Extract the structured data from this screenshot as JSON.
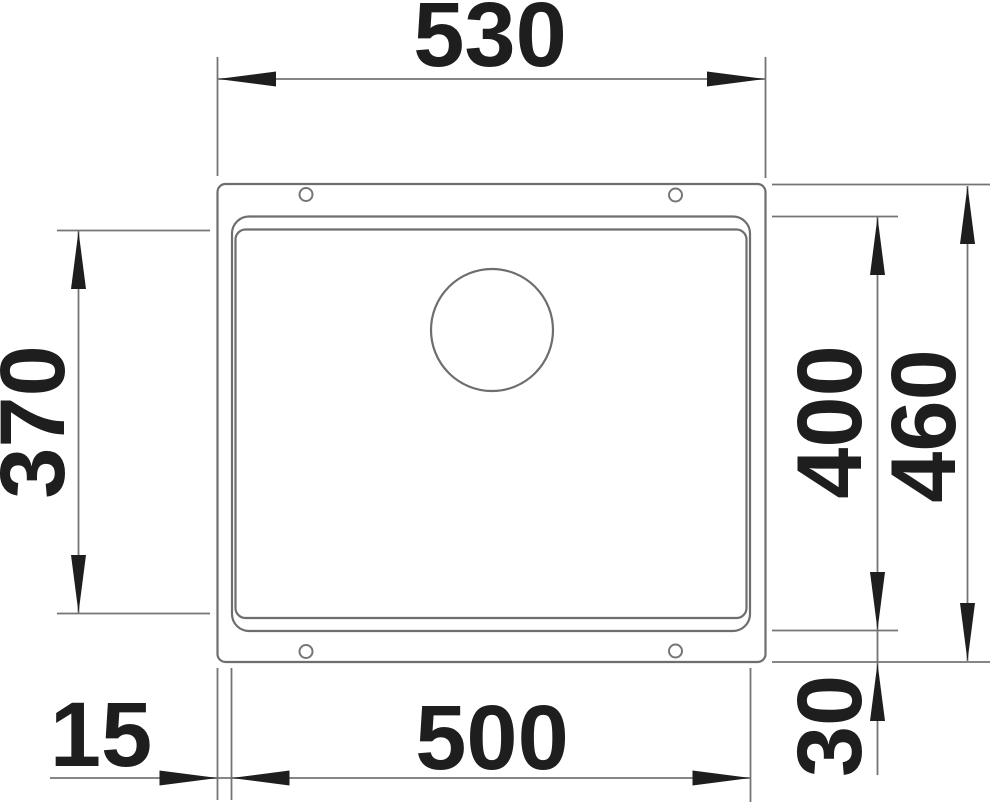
{
  "drawing": {
    "labels": {
      "outer_width": "530",
      "bowl_width": "500",
      "inner_depth": "370",
      "bowl_depth": "400",
      "outer_depth": "460",
      "rim_offset_left": "15",
      "rim_offset_bottom": "30"
    },
    "colors": {
      "line": "#6e6e6e",
      "ink": "#1e1e1e",
      "background": "#ffffff"
    }
  }
}
